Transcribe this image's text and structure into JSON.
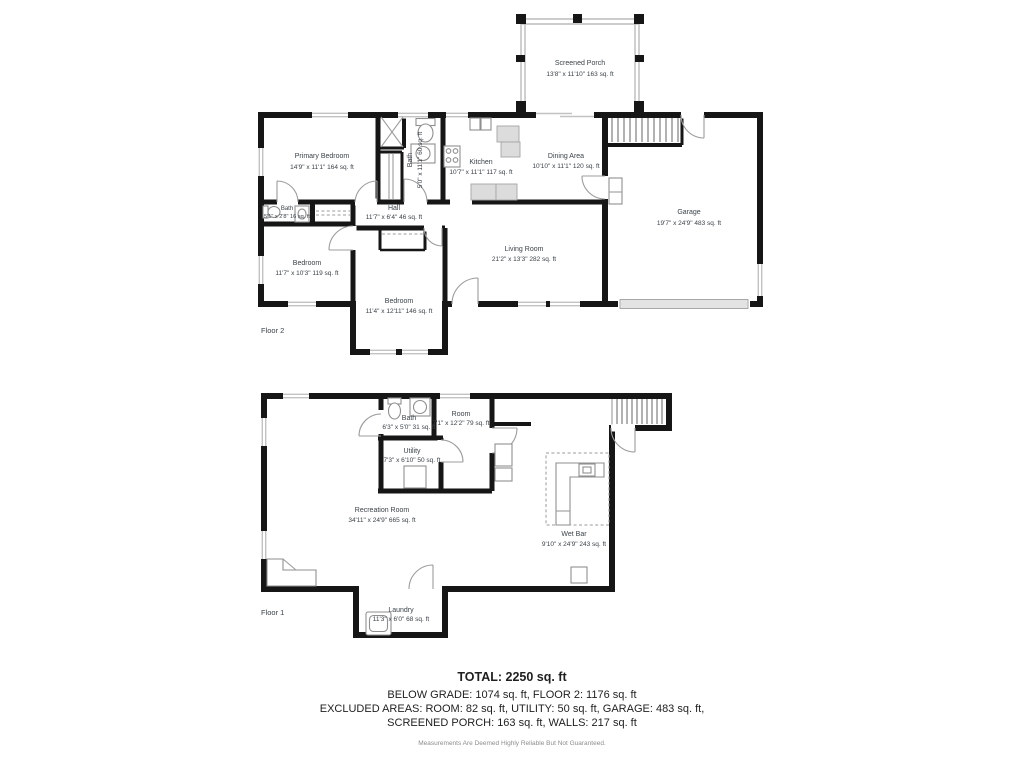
{
  "colors": {
    "walls": "#161616",
    "fixtures": "#8f8f8f",
    "windows": "#c2c2c2",
    "labels": "#3b4248",
    "summary_text": "#1f1f1f",
    "disclaimer": "#8d8d8d"
  },
  "floor2": {
    "label": "Floor 2",
    "rooms": [
      {
        "name": "Screened Porch",
        "dims": "13'8\" x 11'10\" 163 sq. ft"
      },
      {
        "name": "Primary Bedroom",
        "dims": "14'9\" x 11'1\" 164 sq. ft"
      },
      {
        "name": "Bath",
        "dims": "5'0\" x 11'1\" 60 sq. ft"
      },
      {
        "name": "Kitchen",
        "dims": "10'7\" x 11'1\" 117 sq. ft"
      },
      {
        "name": "Dining Area",
        "dims": "10'10\" x 11'1\" 120 sq. ft"
      },
      {
        "name": "Garage",
        "dims": "19'7\" x 24'9\" 483 sq. ft"
      },
      {
        "name": "Bath",
        "dims": "5'1\" x 2'8\" 16 sq. ft"
      },
      {
        "name": "Hall",
        "dims": "11'7\" x 6'4\" 46 sq. ft"
      },
      {
        "name": "Bedroom",
        "dims": "11'7\" x 10'3\" 119 sq. ft"
      },
      {
        "name": "Bedroom",
        "dims": "11'4\" x 12'11\" 146 sq. ft"
      },
      {
        "name": "Living Room",
        "dims": "21'2\" x 13'3\" 282 sq. ft"
      }
    ]
  },
  "floor1": {
    "label": "Floor 1",
    "rooms": [
      {
        "name": "Bath",
        "dims": "6'3\" x 5'0\" 31 sq. ft"
      },
      {
        "name": "Room",
        "dims": "7'1\" x 12'2\" 79 sq. ft"
      },
      {
        "name": "Utility",
        "dims": "7'3\" x 6'10\" 50 sq. ft"
      },
      {
        "name": "Recreation Room",
        "dims": "34'11\" x 24'9\" 665 sq. ft"
      },
      {
        "name": "Wet Bar",
        "dims": "9'10\" x 24'9\" 243 sq. ft"
      },
      {
        "name": "Laundry",
        "dims": "11'3\" x 6'0\" 68 sq. ft"
      }
    ]
  },
  "summary": {
    "total": "TOTAL: 2250 sq. ft",
    "line2": "BELOW GRADE: 1074 sq. ft, FLOOR 2: 1176 sq. ft",
    "line3": "EXCLUDED AREAS: ROOM: 82 sq. ft, UTILITY: 50 sq. ft, GARAGE: 483 sq. ft,",
    "line4": "SCREENED PORCH: 163 sq. ft, WALLS: 217 sq. ft",
    "disclaimer": "Measurements Are Deemed Highly Reliable But Not Guaranteed."
  }
}
